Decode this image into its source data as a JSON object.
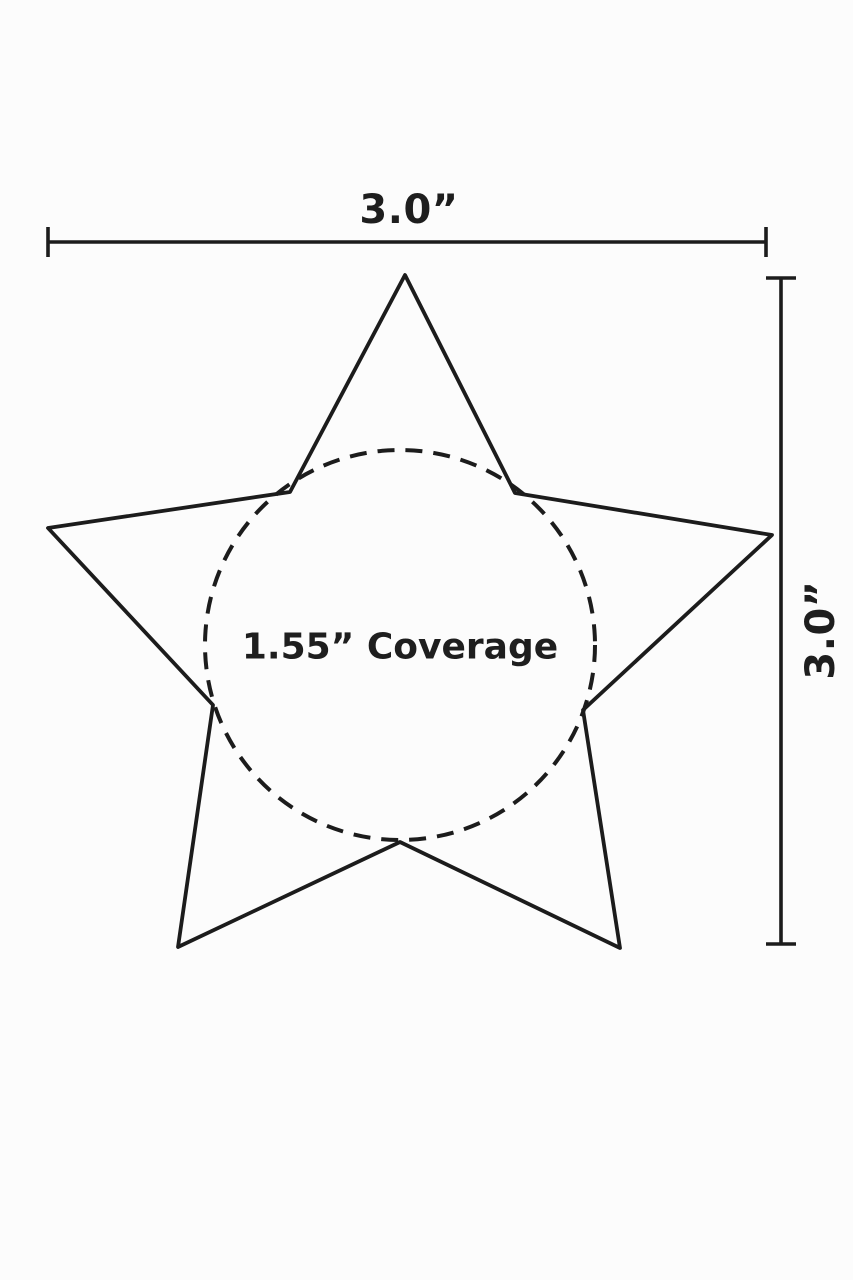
{
  "diagram": {
    "width_label": "3.0”",
    "height_label": "3.0”",
    "coverage_label": "1.55” Coverage",
    "shape": "five-point star outline with dashed inner coverage circle",
    "width_value_inches": 3.0,
    "height_value_inches": 3.0,
    "coverage_value_inches": 1.55
  },
  "colors": {
    "line": "#1c1c1c",
    "text": "#1e1e1e",
    "background": "#fcfcfc"
  }
}
